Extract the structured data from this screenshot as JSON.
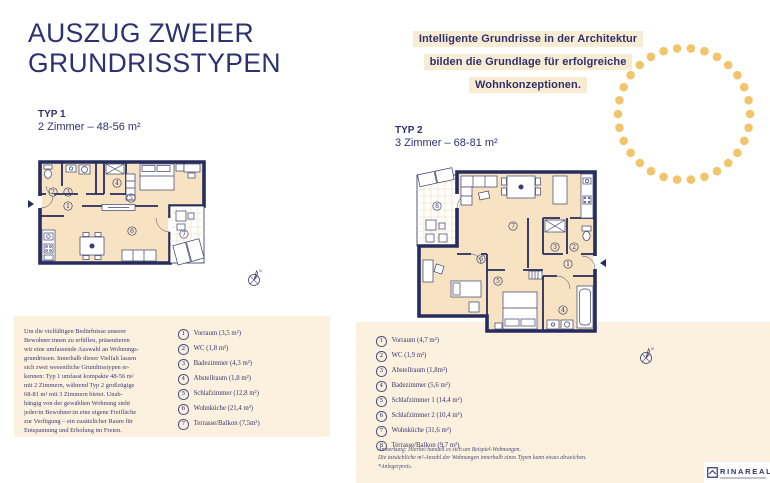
{
  "page_title": [
    "AUSZUG ZWEIER",
    "GRUNDRISSTYPEN"
  ],
  "intro": {
    "line1": "Intelligente Grundrisse in der Architektur",
    "line2": "bilden die Grundlage für erfolgreiche",
    "line3": "Wohnkonzeptionen."
  },
  "typ1": {
    "heading": "TYP 1",
    "subheading": "2 Zimmer – 48-56 m²",
    "description": [
      "Um die vielfältigen Bedürfnisse unserer",
      "Bewohner:innen zu erfüllen, präsentieren",
      "wir eine umfassende Auswahl an Wohnungs-",
      "grundrissen. Innerhalb dieser Vielfalt lassen",
      "sich zwei wesentliche Grundrisstypen er-",
      "kennen: Typ 1 umfasst kompakte 48-56 m²",
      "mit 2 Zimmern, während Typ 2 großzügige",
      "68-81 m² mit 3 Zimmern bietet. Unab-",
      "hängig von der gewählten Wohnung steht",
      "jeder/m Bewohner:in eine eigene Freifläche",
      "zur Verfügung – ein zusätzlicher Raum für",
      "Entspannung und Erholung im Freien."
    ],
    "rooms": [
      {
        "num": "1",
        "label": "Vorraum (3,5 m²)"
      },
      {
        "num": "2",
        "label": "WC (1,8 m²)"
      },
      {
        "num": "3",
        "label": "Badezimmer (4,3 m²)"
      },
      {
        "num": "4",
        "label": "Abstellraum (1,8 m²)"
      },
      {
        "num": "5",
        "label": "Schlafzimmer (12,8 m²)"
      },
      {
        "num": "6",
        "label": "Wohnküche (21,4 m²)"
      },
      {
        "num": "7",
        "label": "Terrasse/Balkon (7,5m²)"
      }
    ]
  },
  "typ2": {
    "heading": "TYP 2",
    "subheading": "3 Zimmer – 68-81 m²",
    "rooms": [
      {
        "num": "1",
        "label": "Vorraum (4,7 m²)"
      },
      {
        "num": "2",
        "label": "WC (1,9 m²)"
      },
      {
        "num": "3",
        "label": "Abstellraum (1,8m²)"
      },
      {
        "num": "4",
        "label": "Badezimmer (5,6 m²)"
      },
      {
        "num": "5",
        "label": "Schlafzimmer 1 (14,4 m²)"
      },
      {
        "num": "6",
        "label": "Schlafzimmer 2 (10,4 m²)"
      },
      {
        "num": "7",
        "label": "Wohnküche (31,6 m²)"
      },
      {
        "num": "8",
        "label": "Terrasse/Balkon (9,7 m²)"
      }
    ]
  },
  "footnote": {
    "lines": [
      "Anmerkung: Hierbei handelt es sich um Beispiel-Wohnungen.",
      "Die tatsächliche m²-Anzahl der Wohnungen innerhalb eines Typen kann etwas abweichen."
    ],
    "anleger": "*Anlegerpreis."
  },
  "compass": {
    "label": "N"
  },
  "logo": {
    "name": "RINAREAL"
  },
  "colors": {
    "navy": "#2e3070",
    "wall_navy": "#272c5e",
    "cream_box": "#fbf1de",
    "text_highlight": "#f8ecd2",
    "dot_gold": "#f2c56c",
    "plan_room_fill": "#f7e3c1",
    "plan_grid_tan": "#eed7ab"
  }
}
